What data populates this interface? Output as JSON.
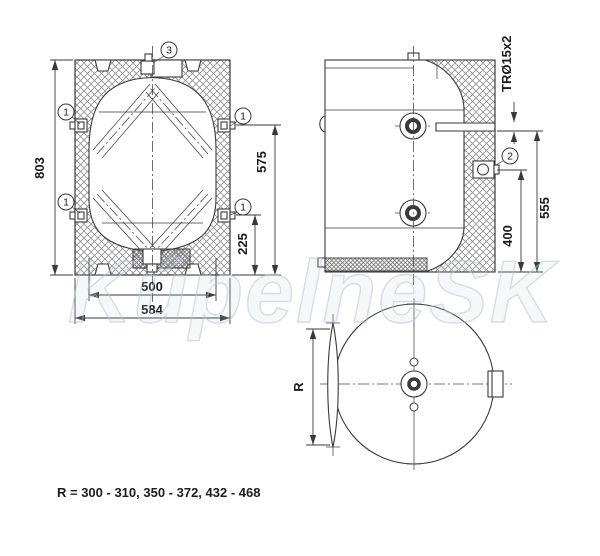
{
  "watermark": {
    "text": "KúpelneSK"
  },
  "note": {
    "text": "R = 300 - 310, 350 - 372, 432 - 468"
  },
  "callouts": {
    "pos1": "1",
    "pos2": "2",
    "pos3": "3"
  },
  "front_view": {
    "dims": {
      "overall_height": "803",
      "upper_connection_height": "575",
      "lower_connection_height": "225",
      "vessel_diameter": "500",
      "overall_width": "584"
    }
  },
  "side_view": {
    "dims": {
      "tube_spec": "TRØ15x2",
      "tube_height": "555",
      "connection_height": "400"
    }
  },
  "bottom_view": {
    "dims": {
      "radius_label": "R"
    }
  },
  "colors": {
    "line": "#3a3a3a",
    "hatch": "#8f8f8f",
    "watermark": "#b8c4d4",
    "background": "#ffffff"
  }
}
